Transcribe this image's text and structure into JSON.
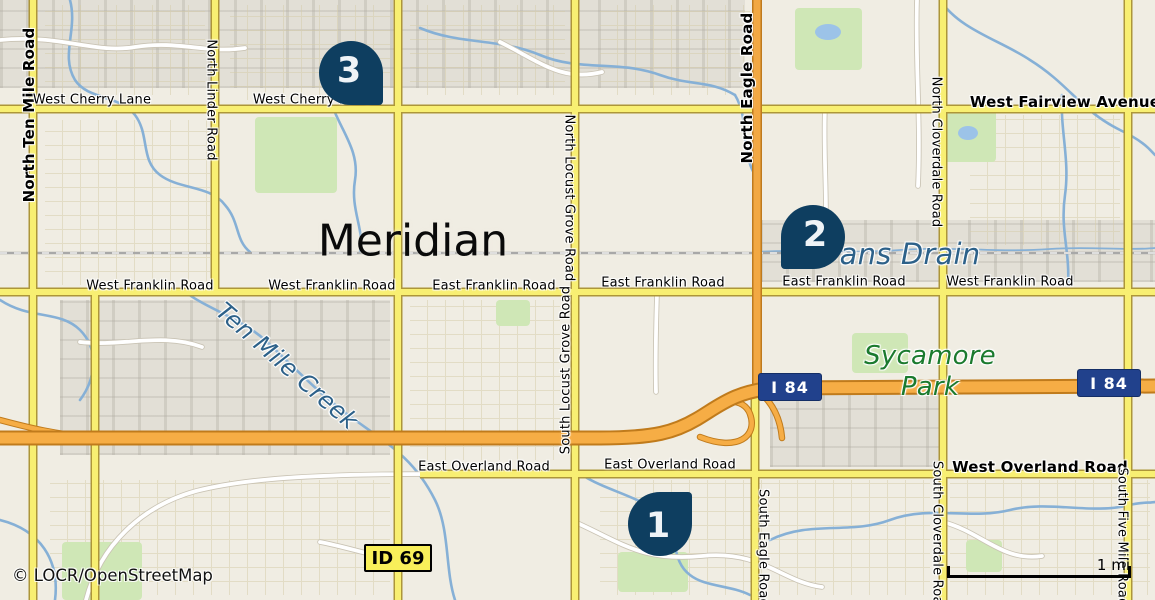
{
  "map": {
    "city_label": "Meridian",
    "attribution": "© LOCR/OpenStreetMap",
    "scale": {
      "label": "1 mi"
    },
    "colors": {
      "background": "#f0ede3",
      "marker": "#0e3e60",
      "marker_number": "#eef3f7",
      "road_major_fill": "#f8ef72",
      "road_major_casing": "#ad9639",
      "road_trunk_fill": "#f2a843",
      "motorway_fill": "#f6ad45",
      "water": "#86b0d6",
      "water_label": "#2d6189",
      "park_label": "#1b7a2e",
      "shield_interstate_bg": "#21418c",
      "shield_state_bg": "#f8ef5a"
    },
    "markers": [
      {
        "number": "1",
        "cx": 660,
        "cy": 524,
        "tail": "tr"
      },
      {
        "number": "2",
        "cx": 813,
        "cy": 237,
        "tail": "bl"
      },
      {
        "number": "3",
        "cx": 351,
        "cy": 73,
        "tail": "br"
      }
    ],
    "shields": [
      {
        "type": "interstate",
        "label": "I 84",
        "x": 790,
        "y": 387
      },
      {
        "type": "interstate",
        "label": "I 84",
        "x": 1109,
        "y": 383
      },
      {
        "type": "state",
        "label": "ID 69",
        "x": 398,
        "y": 558
      }
    ],
    "road_labels": [
      {
        "text": "North Ten Mile Road",
        "x": 29,
        "y": 115,
        "rot": -90,
        "bold": true,
        "size": 15
      },
      {
        "text": "North Linder Road",
        "x": 211,
        "y": 100,
        "rot": 90,
        "size": 13
      },
      {
        "text": "West Cherry Lane",
        "x": 92,
        "y": 100
      },
      {
        "text": "West Cherry Lane",
        "x": 312,
        "y": 100
      },
      {
        "text": "West Fairview Avenue",
        "x": 1065,
        "y": 102,
        "bold": true,
        "size": 15
      },
      {
        "text": "North Eagle Road",
        "x": 747,
        "y": 88,
        "rot": -90,
        "bold": true,
        "size": 15
      },
      {
        "text": "North Locust Grove Road",
        "x": 569,
        "y": 198,
        "rot": 90,
        "size": 13
      },
      {
        "text": "North Cloverdale Road",
        "x": 936,
        "y": 152,
        "rot": 90,
        "size": 13
      },
      {
        "text": "West Franklin Road",
        "x": 150,
        "y": 286
      },
      {
        "text": "West Franklin Road",
        "x": 332,
        "y": 286
      },
      {
        "text": "East Franklin Road",
        "x": 494,
        "y": 286
      },
      {
        "text": "East Franklin Road",
        "x": 663,
        "y": 283
      },
      {
        "text": "East Franklin Road",
        "x": 844,
        "y": 282
      },
      {
        "text": "West Franklin Road",
        "x": 1010,
        "y": 282
      },
      {
        "text": "South Locust Grove Road",
        "x": 566,
        "y": 370,
        "rot": -90,
        "size": 13
      },
      {
        "text": "East Overland Road",
        "x": 484,
        "y": 467
      },
      {
        "text": "East Overland Road",
        "x": 670,
        "y": 465
      },
      {
        "text": "West Overland Road",
        "x": 1040,
        "y": 467,
        "bold": true,
        "size": 15
      },
      {
        "text": "South Eagle Road",
        "x": 763,
        "y": 548,
        "rot": 90,
        "size": 13
      },
      {
        "text": "South Cloverdale Road",
        "x": 937,
        "y": 537,
        "rot": 90,
        "size": 13
      },
      {
        "text": "South Five Mile Road",
        "x": 1122,
        "y": 537,
        "rot": 90,
        "size": 13
      }
    ],
    "water_labels": [
      {
        "text": "Ten Mile Creek",
        "x": 287,
        "y": 366,
        "rot": 41,
        "size": 24
      },
      {
        "text": "ans Drain",
        "x": 910,
        "y": 254,
        "rot": 0,
        "size": 29
      }
    ],
    "park_labels": [
      {
        "text": "Sycamore",
        "x": 930,
        "y": 356,
        "size": 26
      },
      {
        "text": "Park",
        "x": 930,
        "y": 387,
        "size": 26
      }
    ]
  }
}
